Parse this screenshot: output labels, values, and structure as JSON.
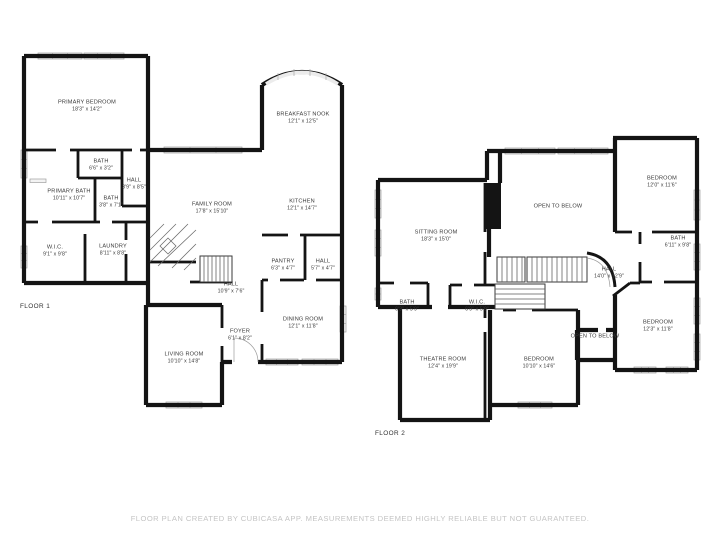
{
  "document": {
    "type": "floor-plan",
    "footer_disclaimer": "FLOOR PLAN CREATED BY CUBICASA APP. MEASUREMENTS DEEMED HIGHLY RELIABLE BUT NOT GUARANTEED."
  },
  "colors": {
    "wall": "#141414",
    "window_fill": "#f3f3f3",
    "window_stroke": "#9f9f9f",
    "label_text": "#3a3a3a",
    "footer_text": "#c4c4c4",
    "background": "#ffffff"
  },
  "floor1": {
    "label": "FLOOR 1",
    "rooms": [
      {
        "name": "PRIMARY BEDROOM",
        "dims": "18'3\" x 14'2\""
      },
      {
        "name": "BATH",
        "dims": "6'6\" x 3'2\""
      },
      {
        "name": "HALL",
        "dims": "3'9\" x 8'5\""
      },
      {
        "name": "PRIMARY BATH",
        "dims": "10'11\" x 10'7\""
      },
      {
        "name": "BATH",
        "dims": "3'8\" x 7'1\""
      },
      {
        "name": "W.I.C.",
        "dims": "9'1\" x 9'8\""
      },
      {
        "name": "LAUNDRY",
        "dims": "8'11\" x 8'8\""
      },
      {
        "name": "FAMILY ROOM",
        "dims": "17'8\" x 15'10\""
      },
      {
        "name": "BREAKFAST NOOK",
        "dims": "12'1\" x 12'5\""
      },
      {
        "name": "KITCHEN",
        "dims": "12'1\" x 14'7\""
      },
      {
        "name": "PANTRY",
        "dims": "6'3\" x 4'7\""
      },
      {
        "name": "HALL",
        "dims": "5'7\" x 4'7\""
      },
      {
        "name": "HALL",
        "dims": "10'9\" x 7'6\""
      },
      {
        "name": "DINING ROOM",
        "dims": "12'1\" x 11'8\""
      },
      {
        "name": "FOYER",
        "dims": "6'1\" x 8'2\""
      },
      {
        "name": "LIVING ROOM",
        "dims": "10'10\" x 14'8\""
      }
    ]
  },
  "floor2": {
    "label": "FLOOR 2",
    "rooms": [
      {
        "name": "SITTING ROOM",
        "dims": "18'3\" x 15'0\""
      },
      {
        "name": "OPEN TO BELOW",
        "dims": ""
      },
      {
        "name": "BEDROOM",
        "dims": "12'0\" x 11'6\""
      },
      {
        "name": "BATH",
        "dims": "6'11\" x 9'8\""
      },
      {
        "name": "HALL",
        "dims": "14'0\" x 12'9\""
      },
      {
        "name": "BATH",
        "dims": "6'3\" x 5'9\""
      },
      {
        "name": "W.I.C.",
        "dims": "6'9\" x 5'9\""
      },
      {
        "name": "THEATRE ROOM",
        "dims": "12'4\" x 19'9\""
      },
      {
        "name": "BEDROOM",
        "dims": "10'10\" x 14'6\""
      },
      {
        "name": "OPEN TO BELOW",
        "dims": ""
      },
      {
        "name": "BEDROOM",
        "dims": "12'3\" x 11'8\""
      }
    ]
  }
}
